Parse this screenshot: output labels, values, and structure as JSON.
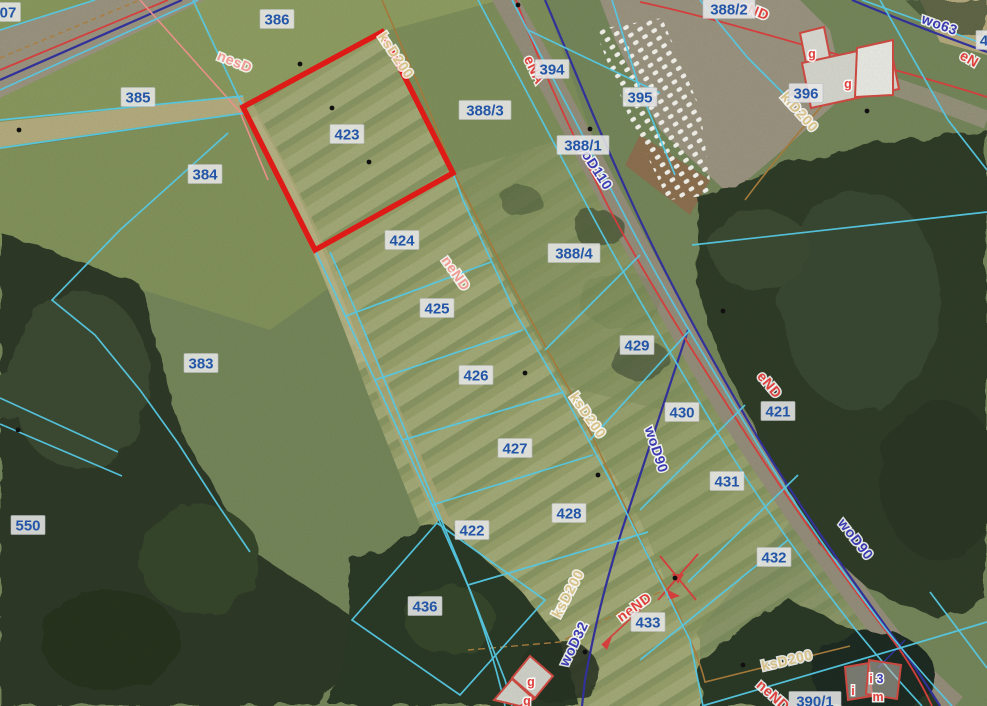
{
  "map": {
    "type": "cadastral-aerial-orthophoto",
    "highlighted_parcel": "423",
    "highlighted_parcel_polygon": "382,32 453,173 315,250 243,107",
    "colors": {
      "parcel_line": "#58cdea",
      "parcel_label_text": "#2456a8",
      "parcel_label_bg": "#e8e8e8",
      "highlight": "#e41b17",
      "utility_power": "#df403c",
      "utility_power_alt": "#f09a92",
      "utility_water": "#3b3bb2",
      "utility_sewer": "#d8c187",
      "building_outline": "#cf4a42"
    },
    "parcel_labels": [
      {
        "text": "386",
        "x": 277,
        "y": 19
      },
      {
        "text": "388/2",
        "x": 729,
        "y": 9
      },
      {
        "text": "385",
        "x": 138,
        "y": 97
      },
      {
        "text": "394",
        "x": 552,
        "y": 69
      },
      {
        "text": "395",
        "x": 640,
        "y": 97
      },
      {
        "text": "396",
        "x": 806,
        "y": 93
      },
      {
        "text": "388/3",
        "x": 485,
        "y": 110
      },
      {
        "text": "388/1",
        "x": 583,
        "y": 145
      },
      {
        "text": "384",
        "x": 205,
        "y": 174
      },
      {
        "text": "423",
        "x": 347,
        "y": 134
      },
      {
        "text": "424",
        "x": 402,
        "y": 240
      },
      {
        "text": "388/4",
        "x": 574,
        "y": 253
      },
      {
        "text": "425",
        "x": 437,
        "y": 308
      },
      {
        "text": "429",
        "x": 637,
        "y": 345
      },
      {
        "text": "383",
        "x": 201,
        "y": 363
      },
      {
        "text": "426",
        "x": 476,
        "y": 375
      },
      {
        "text": "430",
        "x": 682,
        "y": 412
      },
      {
        "text": "421",
        "x": 778,
        "y": 411
      },
      {
        "text": "427",
        "x": 515,
        "y": 448
      },
      {
        "text": "431",
        "x": 727,
        "y": 481
      },
      {
        "text": "428",
        "x": 569,
        "y": 513
      },
      {
        "text": "550",
        "x": 28,
        "y": 525
      },
      {
        "text": "422",
        "x": 472,
        "y": 530
      },
      {
        "text": "432",
        "x": 774,
        "y": 557
      },
      {
        "text": "436",
        "x": 425,
        "y": 606
      },
      {
        "text": "433",
        "x": 648,
        "y": 622
      },
      {
        "text": "390/1",
        "x": 815,
        "y": 701
      },
      {
        "text": "07",
        "x": 8,
        "y": 12
      },
      {
        "text": "4",
        "x": 984,
        "y": 40
      }
    ],
    "utility_labels": [
      {
        "text": "nesD",
        "x": 233,
        "y": 66,
        "rot": 22,
        "kind": "power_alt"
      },
      {
        "text": "ksD200",
        "x": 392,
        "y": 58,
        "rot": 56,
        "kind": "sewer"
      },
      {
        "text": "eNA",
        "x": 530,
        "y": 72,
        "rot": 65,
        "kind": "power"
      },
      {
        "text": "eND",
        "x": 753,
        "y": 15,
        "rot": 22,
        "kind": "power"
      },
      {
        "text": "wo63",
        "x": 938,
        "y": 29,
        "rot": 20,
        "kind": "water"
      },
      {
        "text": "eN",
        "x": 967,
        "y": 63,
        "rot": 30,
        "kind": "power"
      },
      {
        "text": "klD200",
        "x": 796,
        "y": 115,
        "rot": 48,
        "kind": "sewer"
      },
      {
        "text": "woD110",
        "x": 590,
        "y": 168,
        "rot": 57,
        "kind": "water"
      },
      {
        "text": "neND",
        "x": 452,
        "y": 276,
        "rot": 55,
        "kind": "power_alt"
      },
      {
        "text": "eND",
        "x": 766,
        "y": 388,
        "rot": 50,
        "kind": "power"
      },
      {
        "text": "ksD200",
        "x": 584,
        "y": 418,
        "rot": 55,
        "kind": "sewer"
      },
      {
        "text": "woD90",
        "x": 652,
        "y": 451,
        "rot": 72,
        "kind": "water"
      },
      {
        "text": "woD90",
        "x": 852,
        "y": 542,
        "rot": 52,
        "kind": "water"
      },
      {
        "text": "ksD200",
        "x": 572,
        "y": 596,
        "rot": -62,
        "kind": "sewer"
      },
      {
        "text": "woD32",
        "x": 578,
        "y": 646,
        "rot": -64,
        "kind": "water"
      },
      {
        "text": "neND",
        "x": 637,
        "y": 611,
        "rot": -36,
        "kind": "power"
      },
      {
        "text": "ksD200",
        "x": 788,
        "y": 665,
        "rot": -13,
        "kind": "sewer"
      },
      {
        "text": "neND",
        "x": 770,
        "y": 699,
        "rot": 42,
        "kind": "power"
      }
    ],
    "building_labels": [
      {
        "text": "g",
        "x": 812,
        "y": 58,
        "kind": "power"
      },
      {
        "text": "g",
        "x": 848,
        "y": 88,
        "kind": "power"
      },
      {
        "text": "g",
        "x": 531,
        "y": 686,
        "kind": "power"
      },
      {
        "text": "g",
        "x": 527,
        "y": 705,
        "kind": "power"
      },
      {
        "text": "i",
        "x": 853,
        "y": 695,
        "kind": "power"
      },
      {
        "text": "m",
        "x": 878,
        "y": 701,
        "kind": "power"
      },
      {
        "text": "i",
        "x": 871,
        "y": 683,
        "kind": "power"
      },
      {
        "text": "3",
        "x": 880,
        "y": 683,
        "kind": "water_big"
      }
    ],
    "survey_points": [
      [
        300,
        64
      ],
      [
        332,
        108
      ],
      [
        369,
        162
      ],
      [
        19,
        130
      ],
      [
        18,
        430
      ],
      [
        518,
        5
      ],
      [
        590,
        129
      ],
      [
        723,
        311
      ],
      [
        525,
        373
      ],
      [
        598,
        475
      ],
      [
        585,
        652
      ],
      [
        675,
        578
      ],
      [
        743,
        665
      ],
      [
        857,
        535
      ],
      [
        867,
        111
      ]
    ]
  }
}
